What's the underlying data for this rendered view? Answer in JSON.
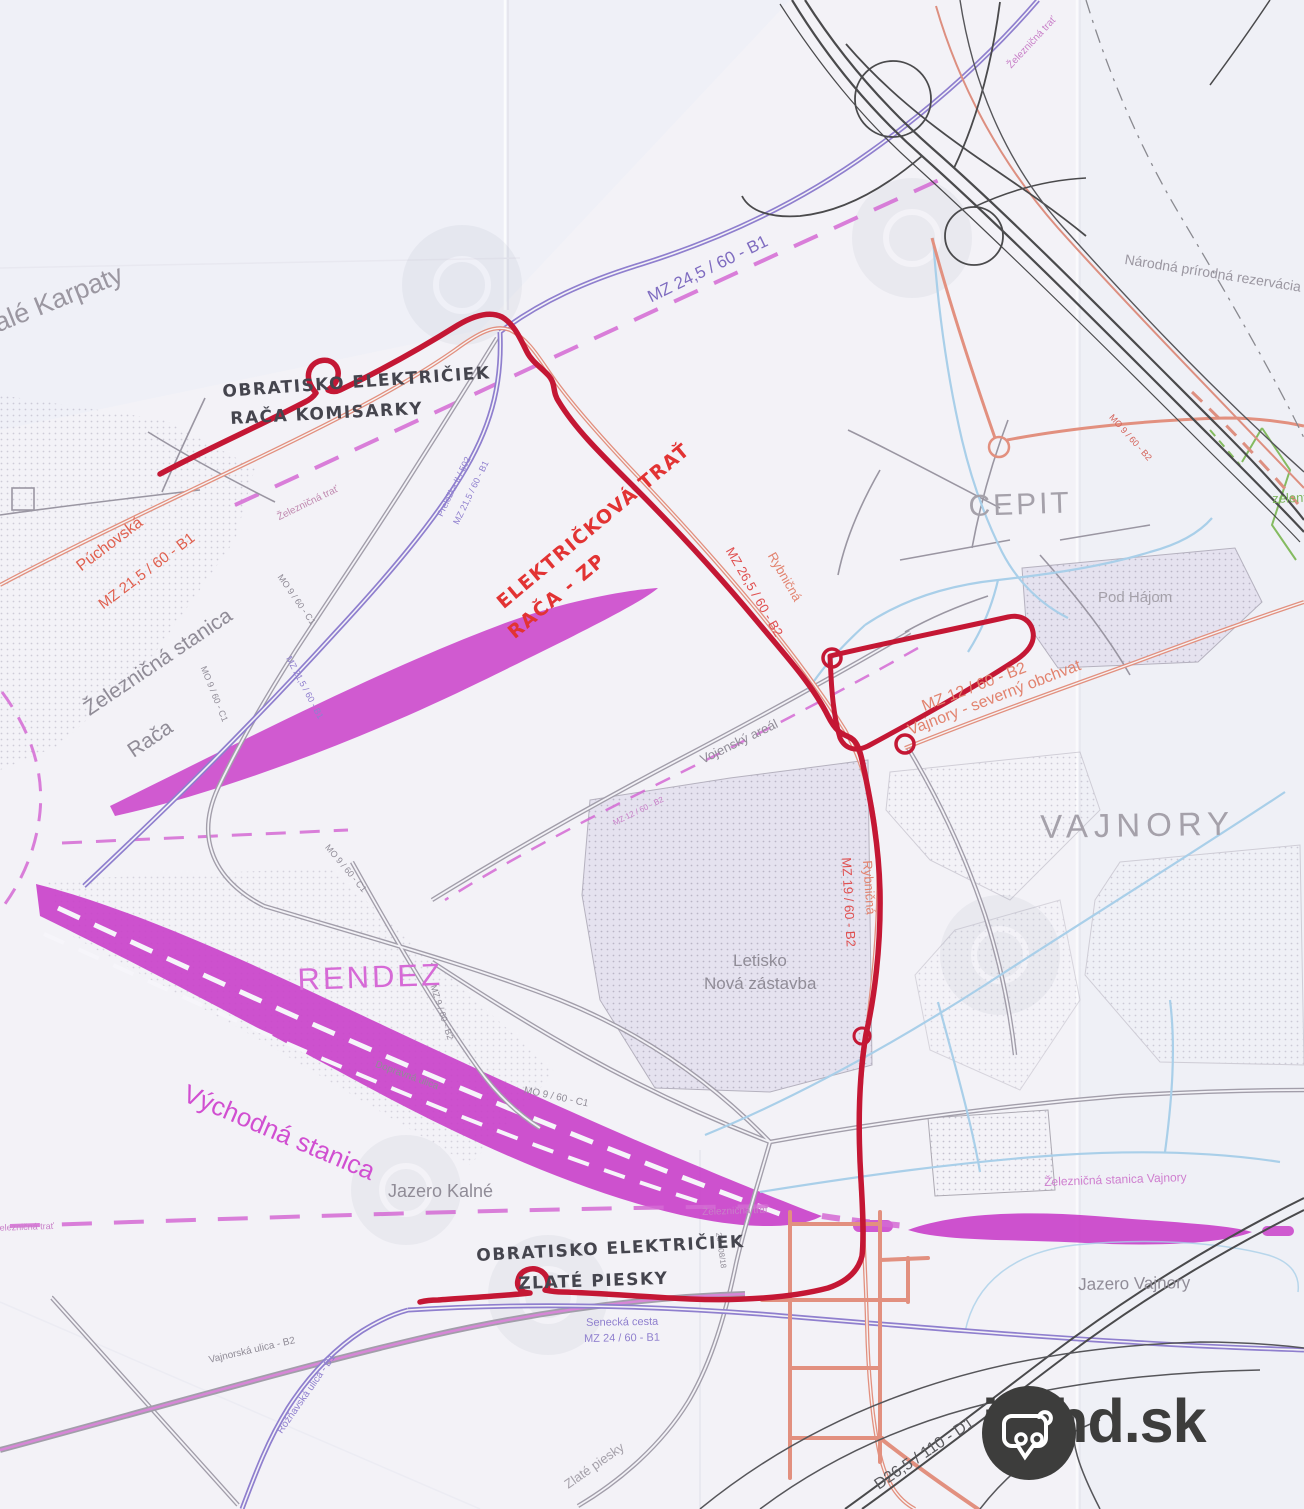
{
  "map": {
    "colors": {
      "paper": "#f3f2f7",
      "tram_hand_drawn_red": "#c41734",
      "road_salmon": "#e2907f",
      "road_purple": "#8f7fce",
      "railway_magenta": "#c93fc9",
      "dashed_magenta": "#d36ad3",
      "water_blue": "#a9cfe9",
      "greenway_green": "#84bb60",
      "road_gray": "#9a96a2",
      "label_gray": "#908c97",
      "highway_black": "#4a4a4c",
      "logo_dark": "#3d3d3c"
    },
    "logo": {
      "text": "imhd.sk"
    },
    "labels": [
      {
        "id": "label-male-karpaty",
        "text": "alé Karpaty",
        "x": -10,
        "y": 312,
        "rot": -22,
        "size": 27,
        "color": "#9b97a1"
      },
      {
        "id": "label-nat-reserve",
        "text": "Národná prírodná rezervácia Š",
        "x": 1126,
        "y": 252,
        "rot": 9,
        "size": 14,
        "color": "#9b97a1"
      },
      {
        "id": "label-mz245",
        "text": "MZ 24,5 / 60 - B1",
        "x": 645,
        "y": 290,
        "rot": -26,
        "size": 17,
        "color": "#7f6cc0"
      },
      {
        "id": "label-zel-trat-tr",
        "text": "Železničná trať",
        "x": 1006,
        "y": 64,
        "rot": -47,
        "size": 10,
        "color": "#c87fc8"
      },
      {
        "id": "label-obratisko-raca-1",
        "text": "OBRATISKO ELEKTRIČIEK",
        "x": 222,
        "y": 384,
        "rot": -4,
        "size": 17,
        "cls": "hand"
      },
      {
        "id": "label-obratisko-raca-2",
        "text": "RAČA KOMISARKY",
        "x": 230,
        "y": 411,
        "rot": -3,
        "size": 17,
        "cls": "hand"
      },
      {
        "id": "label-elektrickova-1",
        "text": "ELEKTRIČKOVÁ TRAŤ",
        "x": 494,
        "y": 598,
        "rot": -40,
        "size": 19,
        "cls": "hand hand-red"
      },
      {
        "id": "label-elektrickova-2",
        "text": "RAČA - ZP",
        "x": 505,
        "y": 628,
        "rot": -40,
        "size": 19,
        "cls": "hand hand-red"
      },
      {
        "id": "label-puchovska",
        "text": "Púchovská",
        "x": 74,
        "y": 562,
        "rot": -37,
        "size": 16,
        "color": "#e0604f"
      },
      {
        "id": "label-mz215-red",
        "text": "MZ 21,5 / 60 - B1",
        "x": 96,
        "y": 600,
        "rot": -37,
        "size": 15,
        "color": "#e0604f"
      },
      {
        "id": "label-zel-trat-raca",
        "text": "Železničná trať",
        "x": 276,
        "y": 514,
        "rot": -26,
        "size": 10,
        "color": "#c08ab0"
      },
      {
        "id": "label-prelozka",
        "text": "Preložka II / 502",
        "x": 436,
        "y": 514,
        "rot": -64,
        "size": 9,
        "color": "#8f7fce"
      },
      {
        "id": "label-mz215-purple-a",
        "text": "MZ 21,5 / 60 - B1",
        "x": 452,
        "y": 522,
        "rot": -64,
        "size": 9,
        "color": "#8f7fce"
      },
      {
        "id": "label-stanica-raca-1",
        "text": "Železničná stanica",
        "x": 80,
        "y": 702,
        "rot": -34,
        "size": 21,
        "color": "#908c97"
      },
      {
        "id": "label-stanica-raca-2",
        "text": "Rača",
        "x": 124,
        "y": 744,
        "rot": -34,
        "size": 21,
        "color": "#908c97"
      },
      {
        "id": "label-mo9-c1-a",
        "text": "MO 9 / 60 - C1",
        "x": 283,
        "y": 573,
        "rot": 55,
        "size": 9,
        "color": "#908c97"
      },
      {
        "id": "label-mo9-c1-b",
        "text": "MO 9 / 60 - C1",
        "x": 207,
        "y": 665,
        "rot": 68,
        "size": 9,
        "color": "#908c97"
      },
      {
        "id": "label-mz215-purple-b",
        "text": "MZ 21,5 / 60 - B1",
        "x": 292,
        "y": 655,
        "rot": 62,
        "size": 9,
        "color": "#8f7fce"
      },
      {
        "id": "label-cepit",
        "text": "CEPIT",
        "x": 968,
        "y": 492,
        "rot": -2,
        "size": 30,
        "color": "#a5a1aa",
        "spacing": 3
      },
      {
        "id": "label-pod-hajom",
        "text": "Pod Hájom",
        "x": 1098,
        "y": 590,
        "rot": 0,
        "size": 15,
        "color": "#a5a1aa"
      },
      {
        "id": "label-mo9-b2",
        "text": "MO 9 / 60 - B2",
        "x": 1114,
        "y": 413,
        "rot": 48,
        "size": 9,
        "color": "#d4635a"
      },
      {
        "id": "label-zeleny",
        "text": "zelený",
        "x": 1272,
        "y": 492,
        "rot": -2,
        "size": 13,
        "color": "#7cb55c"
      },
      {
        "id": "label-mz12-obchvat",
        "text": "MZ 12 / 60 - B2",
        "x": 920,
        "y": 700,
        "rot": -21,
        "size": 16,
        "color": "#e2836f"
      },
      {
        "id": "label-obchvat2",
        "text": "Vajnory - severný obchvat",
        "x": 906,
        "y": 724,
        "rot": -21,
        "size": 16,
        "color": "#e2836f"
      },
      {
        "id": "label-vajnory",
        "text": "VAJNORY",
        "x": 1040,
        "y": 810,
        "rot": -1,
        "size": 33,
        "color": "#a5a1aa",
        "spacing": 6
      },
      {
        "id": "label-mz265",
        "text": "MZ 26,5 / 60 - B2",
        "x": 735,
        "y": 545,
        "rot": 60,
        "size": 13,
        "color": "#e05050"
      },
      {
        "id": "label-rybnicna-1",
        "text": "Rybničná",
        "x": 777,
        "y": 550,
        "rot": 60,
        "size": 13,
        "color": "#e2836f"
      },
      {
        "id": "label-mz19",
        "text": "MZ 19 / 60 - B2",
        "x": 853,
        "y": 857,
        "rot": 87,
        "size": 13,
        "color": "#e05050"
      },
      {
        "id": "label-rybnicna-2",
        "text": "Rybničná",
        "x": 874,
        "y": 860,
        "rot": 86,
        "size": 13,
        "color": "#e2836f"
      },
      {
        "id": "label-rendez",
        "text": "RENDEZ",
        "x": 297,
        "y": 964,
        "rot": -2,
        "size": 31,
        "color": "#d66ad6",
        "spacing": 3
      },
      {
        "id": "label-mz9-b2",
        "text": "MZ 9 / 60 - B2",
        "x": 437,
        "y": 984,
        "rot": 72,
        "size": 9,
        "color": "#908c97"
      },
      {
        "id": "label-dopravna",
        "text": "Dopravná ulica",
        "x": 377,
        "y": 1060,
        "rot": 20,
        "size": 10,
        "color": "#908c97"
      },
      {
        "id": "label-mo9-c1-c",
        "text": "MO 9 / 60 - C1",
        "x": 330,
        "y": 843,
        "rot": 50,
        "size": 9,
        "color": "#908c97"
      },
      {
        "id": "label-mo9-c1-d",
        "text": "MO 9 / 60 - C1",
        "x": 525,
        "y": 1086,
        "rot": 12,
        "size": 10,
        "color": "#908c97"
      },
      {
        "id": "label-vychodna",
        "text": "Východná stanica",
        "x": 190,
        "y": 1080,
        "rot": 23,
        "size": 26,
        "color": "#d14fd1"
      },
      {
        "id": "label-jazero-kalne",
        "text": "Jazero Kalné",
        "x": 388,
        "y": 1182,
        "rot": 0,
        "size": 18,
        "color": "#908c97"
      },
      {
        "id": "label-zel-trat-left",
        "text": "Železničná trať",
        "x": -6,
        "y": 1224,
        "rot": -2,
        "size": 9,
        "color": "#c87fc8"
      },
      {
        "id": "label-zel-trat-mid",
        "text": "Železničná trať",
        "x": 702,
        "y": 1208,
        "rot": -2,
        "size": 10,
        "color": "#c87fc8"
      },
      {
        "id": "label-road-28",
        "text": "28 - 08/18",
        "x": 722,
        "y": 1232,
        "rot": 82,
        "size": 8,
        "color": "#908c97"
      },
      {
        "id": "label-obratisko-zlate-1",
        "text": "OBRATISKO ELEKTRIČIEK",
        "x": 476,
        "y": 1248,
        "rot": -3,
        "size": 17,
        "cls": "hand"
      },
      {
        "id": "label-obratisko-zlate-2",
        "text": "ZLATÉ PIESKY",
        "x": 518,
        "y": 1276,
        "rot": -2,
        "size": 17,
        "cls": "hand"
      },
      {
        "id": "label-senecka",
        "text": "Senecká cesta",
        "x": 586,
        "y": 1318,
        "rot": -1,
        "size": 11,
        "color": "#8f7fce"
      },
      {
        "id": "label-mz24",
        "text": "MZ 24 / 60 - B1",
        "x": 584,
        "y": 1334,
        "rot": -1,
        "size": 11,
        "color": "#8f7fce"
      },
      {
        "id": "label-jazero-vajnory",
        "text": "Jazero Vajnory",
        "x": 1078,
        "y": 1276,
        "rot": -1,
        "size": 17,
        "color": "#908c97"
      },
      {
        "id": "label-stanica-vajnory",
        "text": "Železničná stanica Vajnory",
        "x": 1044,
        "y": 1176,
        "rot": -2,
        "size": 12,
        "color": "#cf7fcf"
      },
      {
        "id": "label-d265",
        "text": "D26,5 / 110 - D1",
        "x": 872,
        "y": 1480,
        "rot": -34,
        "size": 16,
        "color": "#5a5a5e"
      },
      {
        "id": "label-vajnorska",
        "text": "Vajnorská ulica - B2",
        "x": 208,
        "y": 1356,
        "rot": -13,
        "size": 10,
        "color": "#908c97"
      },
      {
        "id": "label-roznavska",
        "text": "Rožňavská ulica - B1",
        "x": 276,
        "y": 1430,
        "rot": -55,
        "size": 10,
        "color": "#8f7fce"
      },
      {
        "id": "label-zlate-piesky",
        "text": "Zlaté piesky",
        "x": 562,
        "y": 1480,
        "rot": -35,
        "size": 13,
        "color": "#a5a1aa"
      },
      {
        "id": "label-vojensky",
        "text": "Vojenský areál",
        "x": 698,
        "y": 754,
        "rot": -26,
        "size": 13,
        "color": "#908c97"
      },
      {
        "id": "label-mz12-dash",
        "text": "MZ 12 / 60 - B2",
        "x": 612,
        "y": 820,
        "rot": -26,
        "size": 8,
        "color": "#c87fc8"
      },
      {
        "id": "label-letisko-1",
        "text": "Letisko",
        "x": 733,
        "y": 952,
        "rot": 0,
        "size": 17,
        "color": "#908c97"
      },
      {
        "id": "label-letisko-2",
        "text": "Nová zástavba",
        "x": 704,
        "y": 975,
        "rot": 0,
        "size": 17,
        "color": "#908c97"
      }
    ]
  }
}
